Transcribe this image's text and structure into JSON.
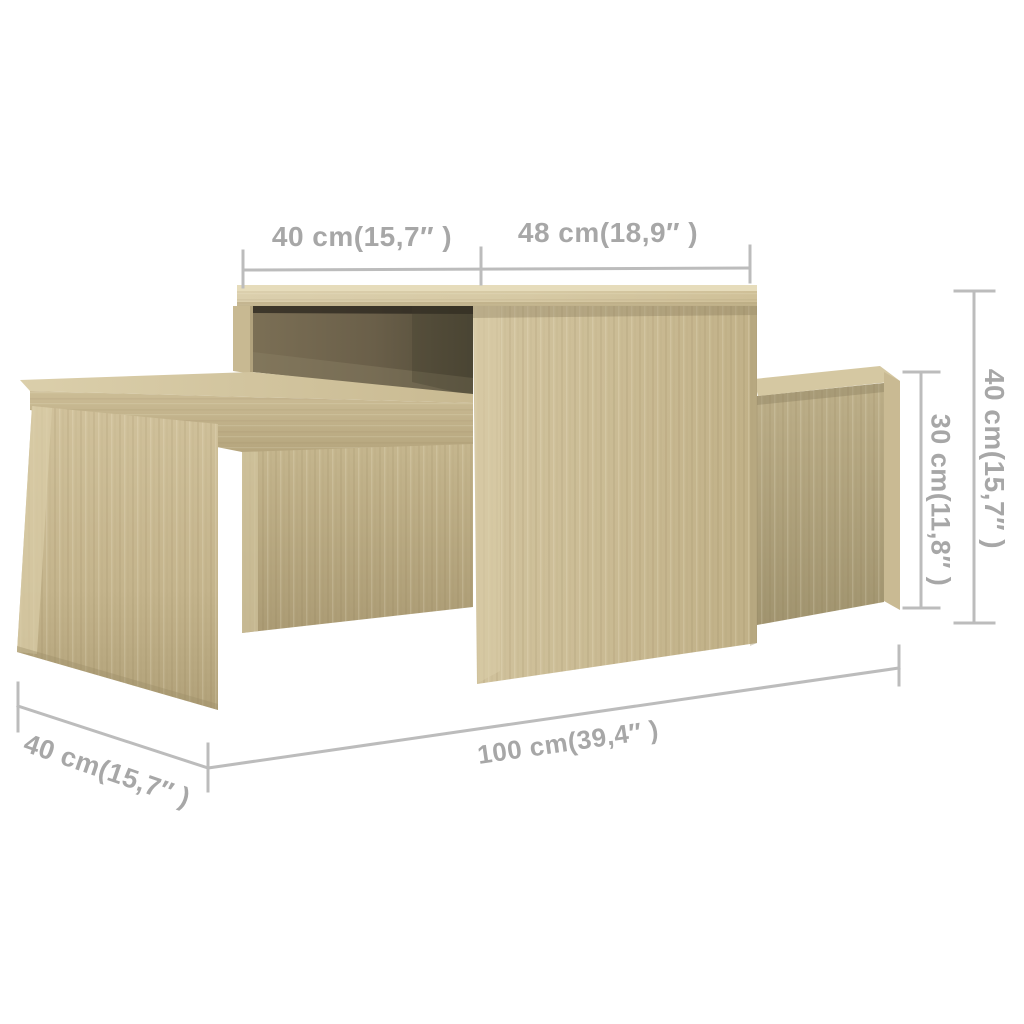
{
  "diagram": {
    "kind": "furniture-dimension-diagram",
    "subject": "nesting coffee table set, sonoma oak",
    "background_color": "#ffffff",
    "line_color": "#bcbcbc",
    "label_color": "#a7a7a7",
    "wood_light": "#dbcfad",
    "wood_mid": "#c9ba93",
    "wood_dark": "#a1946f",
    "recess_shadow": "#4f4937"
  },
  "measurements": {
    "top_overhang": {
      "label": "40 cm(15,7″ )",
      "cm": 40,
      "inches": "15,7"
    },
    "top_main": {
      "label": "48 cm(18,9″ )",
      "cm": 48,
      "inches": "18,9"
    },
    "height_tall": {
      "label": "40 cm(15,7″ )",
      "cm": 40,
      "inches": "15,7"
    },
    "height_low": {
      "label": "30 cm(11,8″ )",
      "cm": 30,
      "inches": "11,8"
    },
    "length_total": {
      "label": "100 cm(39,4″ )",
      "cm": 100,
      "inches": "39,4"
    },
    "depth": {
      "label": "40 cm(15,7″ )",
      "cm": 40,
      "inches": "15,7"
    }
  }
}
